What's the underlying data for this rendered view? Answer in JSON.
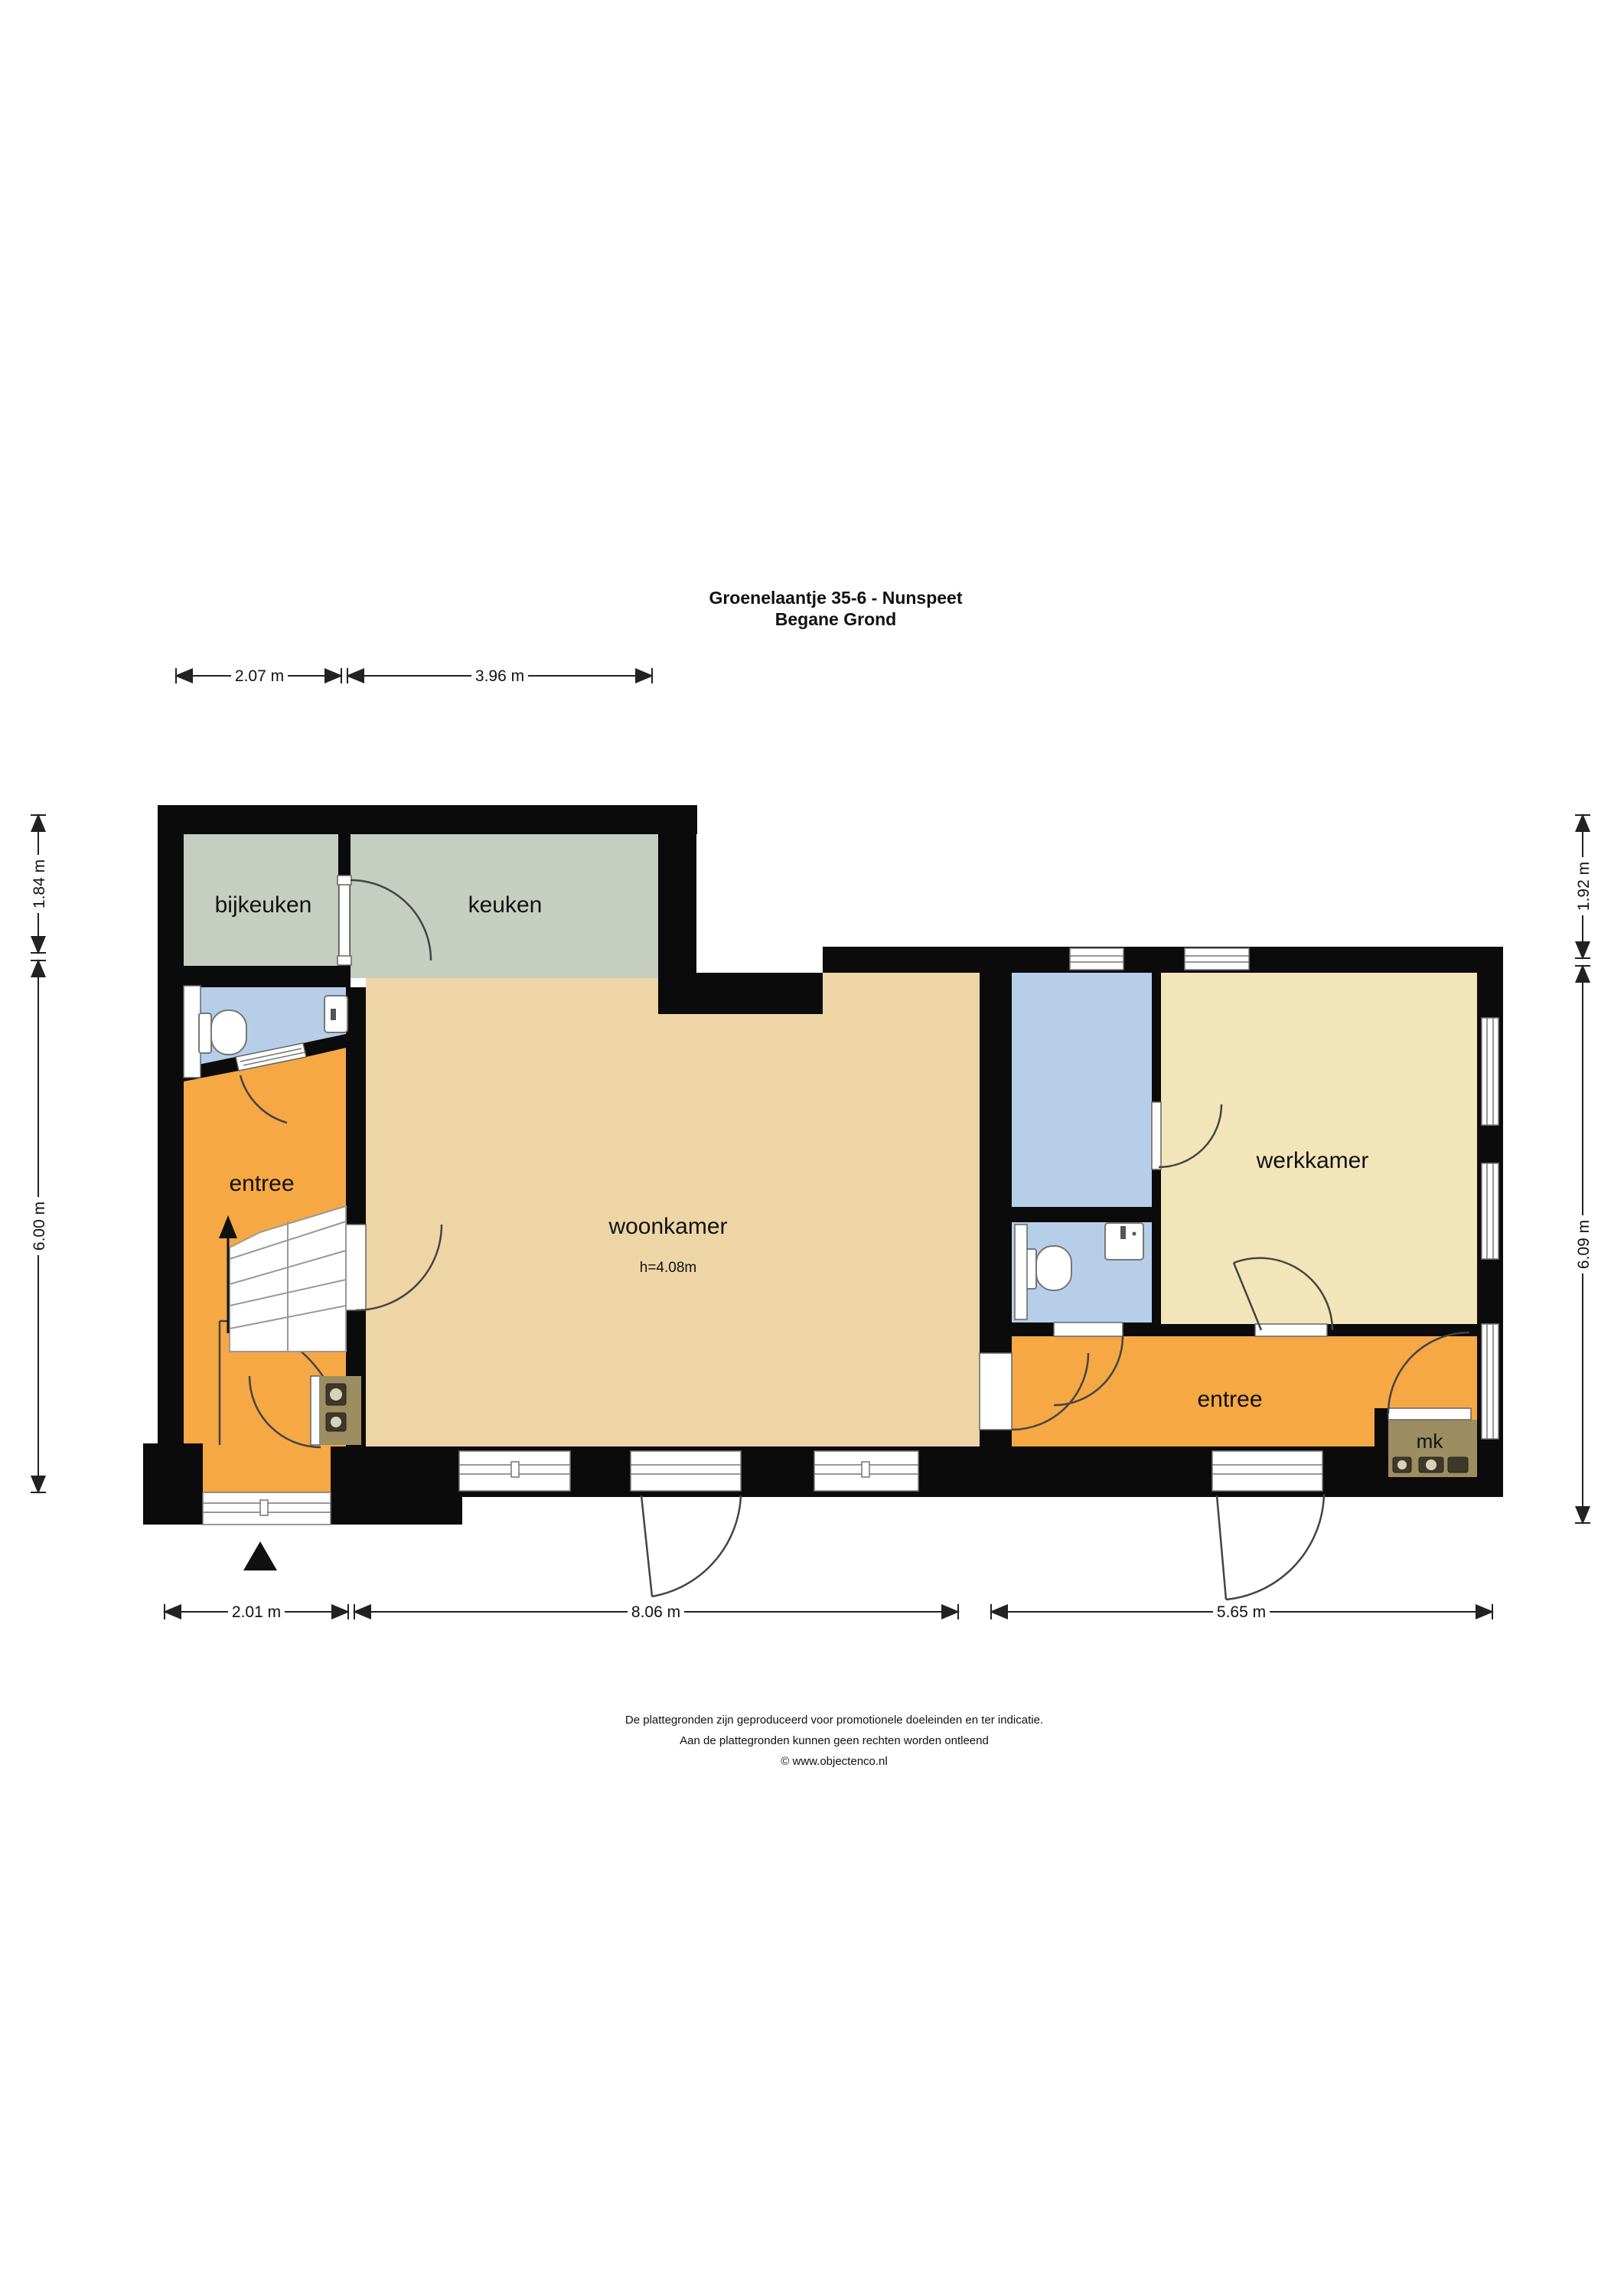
{
  "title": {
    "line1": "Groenelaantje 35-6 - Nunspeet",
    "line2": "Begane Grond"
  },
  "rooms": {
    "bijkeuken": "bijkeuken",
    "keuken": "keuken",
    "woonkamer": "woonkamer",
    "woonkamer_height": "h=4.08m",
    "entree_left": "entree",
    "entree_right": "entree",
    "werkkamer": "werkkamer",
    "mk": "mk"
  },
  "dimensions": {
    "top": [
      "2.07 m",
      "3.96 m"
    ],
    "bottom": [
      "2.01 m",
      "8.06 m",
      "5.65 m"
    ],
    "left": [
      "1.84 m",
      "6.00 m"
    ],
    "right": [
      "1.92 m",
      "6.09 m"
    ]
  },
  "footer": {
    "line1": "De plattegronden zijn geproduceerd voor promotionele doeleinden en ter indicatie.",
    "line2": "Aan de plattegronden kunnen geen rechten worden ontleend",
    "line3": "© www.objectenco.nl"
  },
  "colors": {
    "wall": "#0b0b0b",
    "kitchen": "#c6cdc1",
    "living": "#edd5a6",
    "work": "#f2e5b9",
    "entry": "#f5a844",
    "wet": "#b7cee9",
    "closet": "#9c8d62",
    "background": "#ffffff"
  }
}
